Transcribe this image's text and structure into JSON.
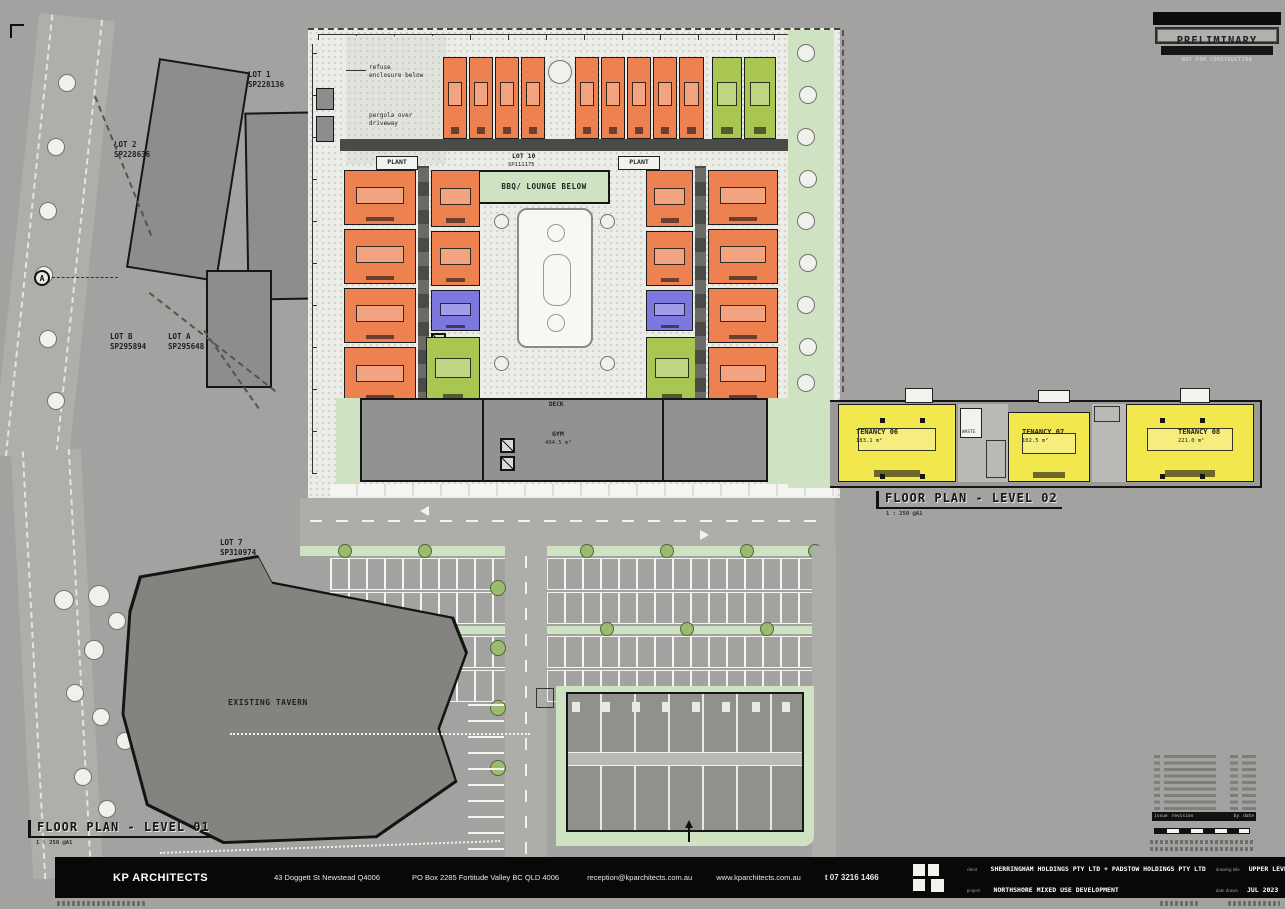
{
  "stamp": {
    "title": "PRELIMINARY",
    "subtitle": "NOT FOR CONSTRUCTION"
  },
  "plan": {
    "lot10": "LOT 10",
    "sp111175": "SP111175",
    "bbq_lounge": "BBQ/ LOUNGE BELOW",
    "plant_left": "PLANT",
    "plant_right": "PLANT",
    "deck": "DECK",
    "gym": "GYM",
    "gym_area": "494.5 m²",
    "waste": "WASTE",
    "refuse_note": "refuse\nenclosure below",
    "pergola_note": "pergola over\ndriveway",
    "existing_tavern": "EXISTING TAVERN"
  },
  "lots": {
    "lot1": "LOT 1\nSP228136",
    "lot2": "LOT 2\nSP228636",
    "lot_b": "LOT B\nSP295894",
    "lot_a": "LOT A\nSP295648",
    "lot7": "LOT 7\nSP310974"
  },
  "tenancies": [
    {
      "name": "TENANCY 06",
      "area": "183.1 m²"
    },
    {
      "name": "TENANCY 07",
      "area": "102.5 m²"
    },
    {
      "name": "TENANCY 08",
      "area": "221.0 m²"
    }
  ],
  "plan_titles": {
    "level02": "FLOOR PLAN - LEVEL 02",
    "level02_scale": "1 : 250 @A1",
    "level01": "FLOOR PLAN - LEVEL 01",
    "level01_scale": "1 : 250 @A1"
  },
  "grid_marker": "A",
  "revision_table": {
    "issue": "issue",
    "revision": "revision",
    "by": "by",
    "date": "date"
  },
  "title_block": {
    "company": "KP ARCHITECTS",
    "address1": "43 Doggett St Newstead Q4006",
    "address2": "PO Box 2285 Fortitude Valley BC QLD 4006",
    "email": "reception@kparchitects.com.au",
    "website": "www.kparchitects.com.au",
    "phone": "t 07 3216 1466",
    "client_label": "client",
    "client": "SHERRINGHAM HOLDINGS PTY LTD + PADSTOW HOLDINGS PTY LTD",
    "project_label": "project",
    "project": "NORTHSHORE MIXED USE DEVELOPMENT",
    "drawing_title_label": "drawing title",
    "drawing_title": "UPPER LEVEL PLAN",
    "date_label": "date drawn",
    "date": "JUL 2023",
    "dwg_no_label": "dwg no",
    "dwg_no": "22019-OD 10.03  S",
    "scale_label": "scale",
    "scale": "1 : 250 @A1"
  },
  "colors": {
    "orange_unit": "#ee8150",
    "green_unit": "#a9c653",
    "blue_unit": "#7d78e0",
    "tenancy_yellow": "#f2e74c",
    "landscape_green": "#cfe2c2"
  }
}
